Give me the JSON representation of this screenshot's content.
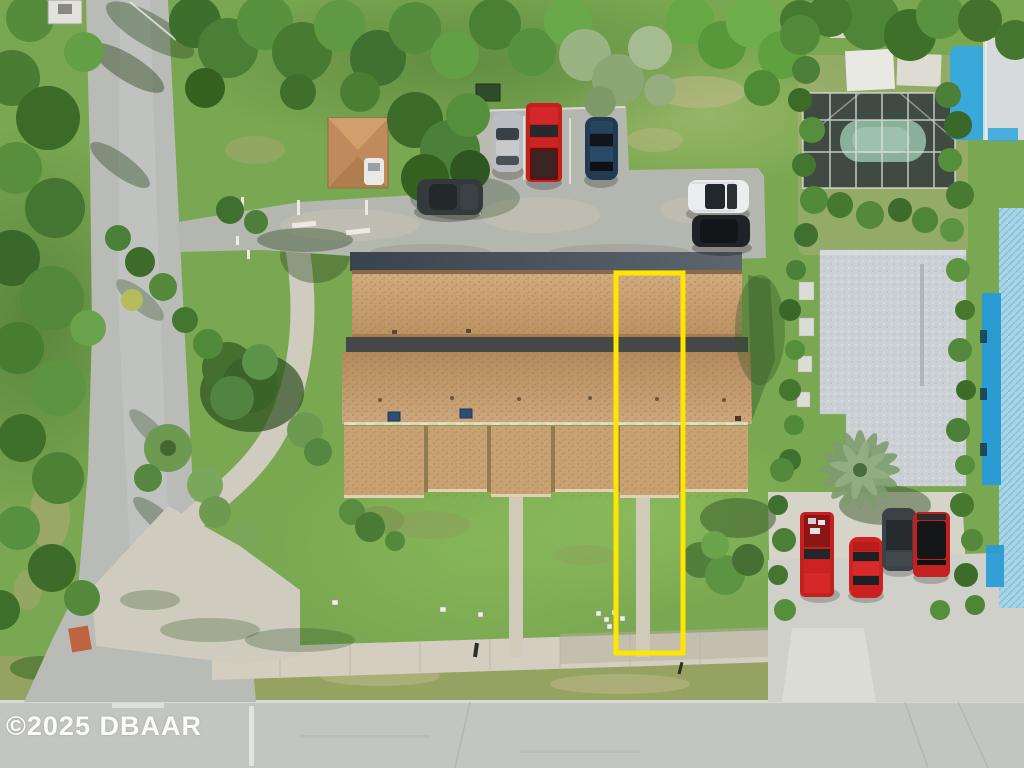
{
  "scene": {
    "watermark": "©2025 DBAAR",
    "highlight_color": "#FFE600"
  },
  "palette": {
    "road": "#B9BBB7",
    "main_road": "#C3C5C1",
    "sidewalk": "#D3CEBF",
    "parking": "#B4B6B0",
    "roof_tan_front": "#C9A274",
    "roof_gray": "#CBD0D4",
    "pool_water": "#8AAF9A",
    "tarp_blue": "#A7D6E8",
    "building_blue": "#2A9CD4"
  },
  "vehicles": {
    "parking_lot": [
      {
        "name": "dark sedan",
        "color": "#34393C"
      },
      {
        "name": "silver car",
        "color": "#B9BDC1"
      },
      {
        "name": "red pickup",
        "color": "#C41E1E"
      },
      {
        "name": "navy sedan",
        "color": "#223B52"
      },
      {
        "name": "white SUV",
        "color": "#EBEDEE"
      },
      {
        "name": "black SUV",
        "color": "#1F2326"
      }
    ],
    "driveway": [
      {
        "name": "red pickup",
        "color": "#C42020"
      },
      {
        "name": "red car",
        "color": "#CC2222"
      },
      {
        "name": "gray SUV",
        "color": "#3C4146"
      },
      {
        "name": "red jeep",
        "color": "#C02020"
      }
    ]
  }
}
